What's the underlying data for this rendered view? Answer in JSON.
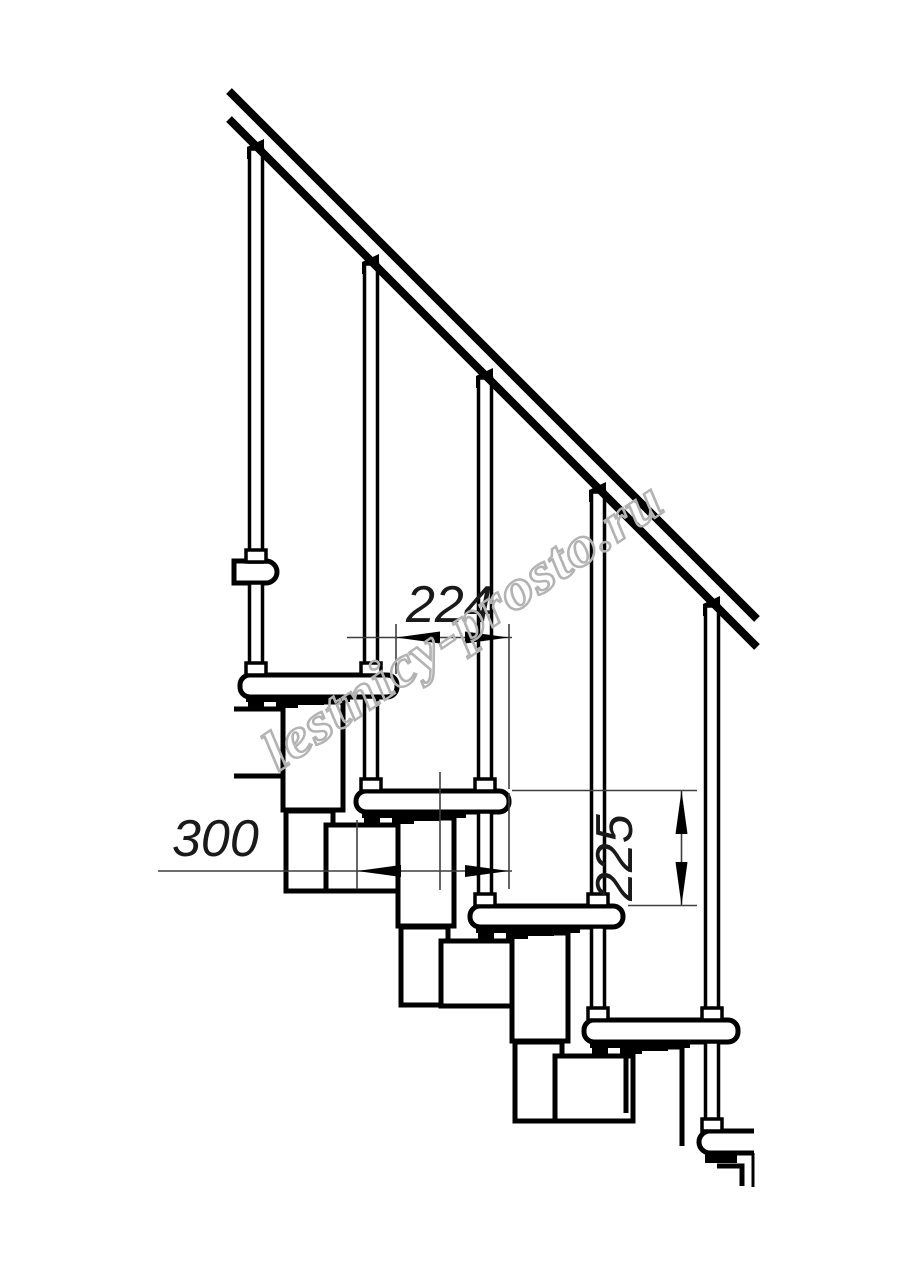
{
  "drawing": {
    "type": "technical-drawing",
    "subject": "modular staircase side view with handrail",
    "background_color": "#ffffff",
    "line_color": "#000000",
    "dimension_line_color": "#3f3f3f",
    "dimensions": {
      "step_going": "224",
      "step_depth": "300",
      "step_rise": "225"
    },
    "watermark": {
      "text": "lestnicy-prosto.ru",
      "color": "#b3b3b3"
    }
  }
}
